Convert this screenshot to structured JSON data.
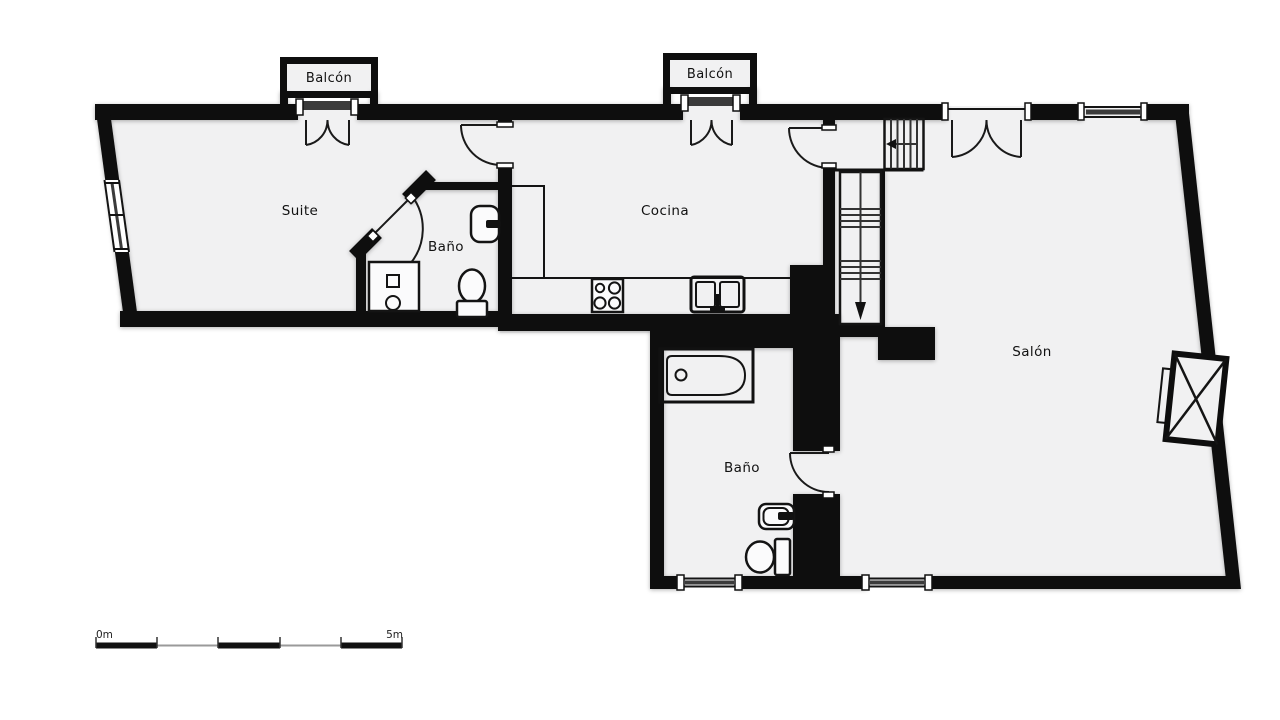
{
  "plan": {
    "rooms": {
      "suite": {
        "label": "Suite"
      },
      "cocina": {
        "label": "Cocina"
      },
      "salon": {
        "label": "Salón"
      },
      "bano_suite": {
        "label": "Baño"
      },
      "bano_principal": {
        "label": "Baño"
      }
    },
    "balconies": {
      "izquierda": {
        "label": "Balcón"
      },
      "centro": {
        "label": "Balcón"
      }
    },
    "scale_bar": {
      "start": "0m",
      "end": "5m"
    },
    "colors": {
      "wall": "#0e0e0e",
      "floor": "#f1f1f2",
      "glass": "#3b3b3b",
      "line": "#1a1a1a"
    }
  }
}
